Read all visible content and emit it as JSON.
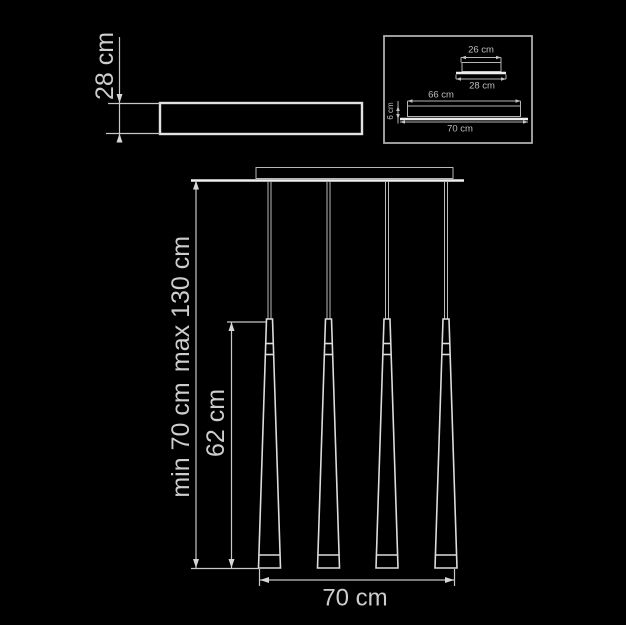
{
  "colors": {
    "background": "#000000",
    "line": "#c7c7c7",
    "bright_line": "#f0f0f0",
    "text": "#cdcdcd"
  },
  "side_view": {
    "depth_label": "28 cm"
  },
  "detail_inset": {
    "canopy_top_width_label": "26 cm",
    "canopy_base_width_label": "28 cm",
    "bar_body_length_label": "66 cm",
    "bar_base_length_label": "70 cm",
    "bar_height_label": "6 cm"
  },
  "front_view": {
    "suspension_max_label": "max 130 cm",
    "suspension_min_label": "min 70 cm",
    "shade_length_label": "62 cm",
    "overall_width_label": "70 cm",
    "pendant_count": 4
  }
}
